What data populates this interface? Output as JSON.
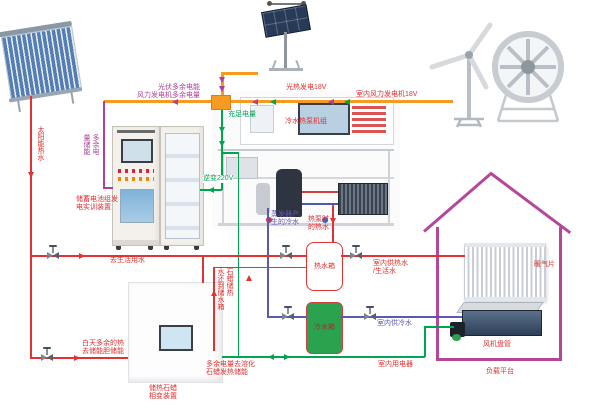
{
  "title": "太阳能/风能冷热电综合利用实训系统图",
  "palette": {
    "hot_water_line": "#e23333",
    "chilled_water_line": "#5a5ab5",
    "electric_220v_line": "#00a550",
    "dc_power_bus": "#f59a23",
    "surplus_power_line": "#b03f9b",
    "house_outline": "#b5479b",
    "cold_tank_fill": "#2ba24e"
  },
  "power": {
    "pv_tracker_label": "光热发电18V",
    "wind_label": "室内风力发电机18V",
    "surplus_label": "光伏多余电能\n风力发电机多余电量",
    "charge_label": "充足电量",
    "surplus_storage_label": "多余电\n量储能",
    "inverter_label": "逆变220V",
    "battery_cabinet_label": "储蓄电池组发\n电实训装置",
    "indoor_load_label": "室内用电器",
    "melt_paraffin_label": "多余电量去溶化\n石蜡发热储能"
  },
  "thermal": {
    "solar_hot_water_label": "太阳能热水",
    "domestic_water_label": "去生活用水",
    "heat_pump_label": "冷水热泵机组",
    "evaporator_cold_label": "蒸发器产\n生的冷水",
    "heatpump_hot_label": "热泵时\n的热水",
    "hot_tank_label": "热水箱",
    "cold_tank_label": "冷水箱",
    "indoor_hot_label": "室内供热水\n/生活水",
    "indoor_cold_label": "室内供冷水",
    "paraffin_return_label": "石蜡储热\n水还到储水箱",
    "day_surplus_label": "白天多余的热\n去储能胆储能",
    "paraffin_device_label": "储热石蜡\n相变装置"
  },
  "house": {
    "radiator_label": "暖气片",
    "fan_coil_label": "风机盘管",
    "platform_label": "负载平台"
  }
}
